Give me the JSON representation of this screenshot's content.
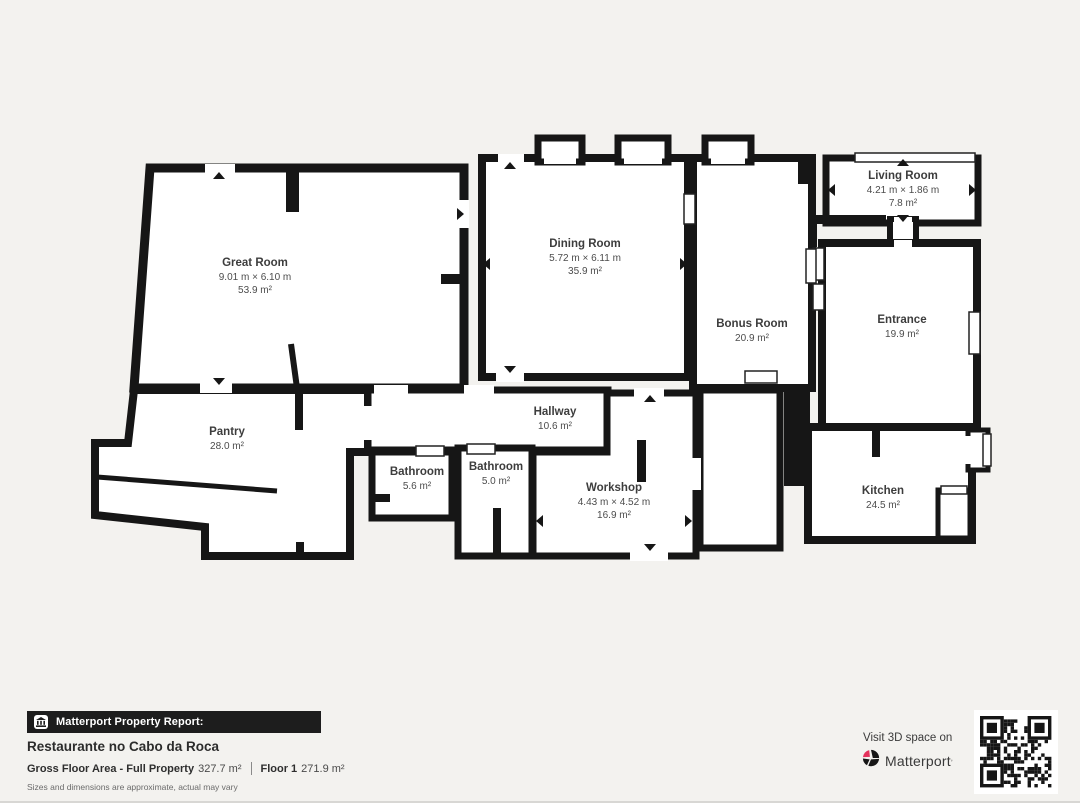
{
  "colors": {
    "background": "#f3f2ef",
    "walls": "#161616",
    "room_fill": "#ffffff",
    "banner_bg": "#1d1d1d",
    "matterport_red": "#e4315b"
  },
  "rooms": [
    {
      "name": "Great Room",
      "dims": "9.01 m × 6.10 m",
      "area": "53.9 m²"
    },
    {
      "name": "Dining Room",
      "dims": "5.72 m × 6.11 m",
      "area": "35.9 m²"
    },
    {
      "name": "Living Room",
      "dims": "4.21 m × 1.86 m",
      "area": "7.8 m²"
    },
    {
      "name": "Bonus Room",
      "dims": "",
      "area": "20.9 m²"
    },
    {
      "name": "Entrance",
      "dims": "",
      "area": "19.9 m²"
    },
    {
      "name": "Pantry",
      "dims": "",
      "area": "28.0 m²"
    },
    {
      "name": "Hallway",
      "dims": "",
      "area": "10.6 m²"
    },
    {
      "name": "Bathroom",
      "dims": "",
      "area": "5.6 m²"
    },
    {
      "name": "Bathroom",
      "dims": "",
      "area": "5.0 m²"
    },
    {
      "name": "Workshop",
      "dims": "4.43 m × 4.52 m",
      "area": "16.9 m²"
    },
    {
      "name": "Kitchen",
      "dims": "",
      "area": "24.5 m²"
    }
  ],
  "footer": {
    "banner_label": "Matterport Property Report:",
    "property_title": "Restaurante no Cabo da Roca",
    "gfa_label": "Gross Floor Area - Full Property",
    "gfa_value": "327.7 m²",
    "floor_label": "Floor 1",
    "floor_value": "271.9 m²",
    "disclaimer": "Sizes and dimensions are approximate, actual may vary"
  },
  "cta": {
    "visit_text": "Visit 3D space on",
    "brand": "Matterport"
  },
  "icons": {
    "building-icon": "bank building glyph in banner",
    "matterport-logo-icon": "black/red pinwheel circle",
    "qr-code": "scannable QR pattern"
  }
}
